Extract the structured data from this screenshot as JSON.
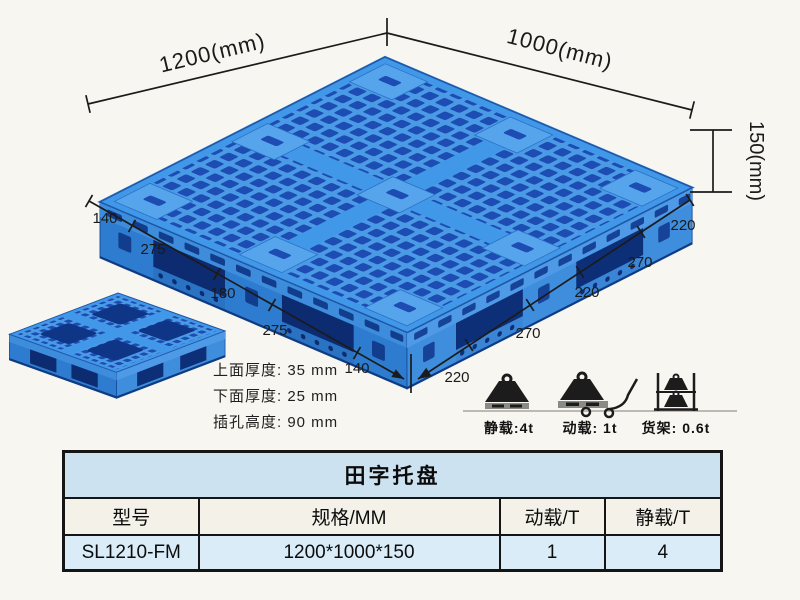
{
  "diagram": {
    "top_width_label": "1200(mm)",
    "top_depth_label": "1000(mm)",
    "height_label": "150(mm)",
    "left_edge_segments": [
      "140",
      "275",
      "180",
      "275",
      "140"
    ],
    "right_edge_segments": [
      "220",
      "270",
      "220",
      "270",
      "220"
    ],
    "thickness_notes": [
      "上面厚度: 35 mm",
      "下面厚度: 25 mm",
      "插孔高度: 90 mm"
    ],
    "load_icons": [
      {
        "icon": "static-load-weight-icon",
        "label": "静载:4t"
      },
      {
        "icon": "dynamic-load-trolley-icon",
        "label": "动载: 1t"
      },
      {
        "icon": "rack-load-shelf-icon",
        "label": "货架: 0.6t"
      }
    ],
    "colors": {
      "pallet_blue": "#2e7ccf",
      "pallet_light_blue": "#4a9ae6",
      "pallet_dark_hole": "#1d4cb2",
      "dimension_line": "#1b1b1b"
    }
  },
  "spec_table": {
    "title": "田字托盘",
    "columns": [
      "型号",
      "规格/MM",
      "动载/T",
      "静载/T"
    ],
    "rows": [
      [
        "SL1210-FM",
        "1200*1000*150",
        "1",
        "4"
      ]
    ],
    "colors": {
      "title_bg": "#cde2f0",
      "header_bg": "#f3f1e8",
      "data_bg": "#d9ecf7",
      "border": "#151515"
    }
  }
}
